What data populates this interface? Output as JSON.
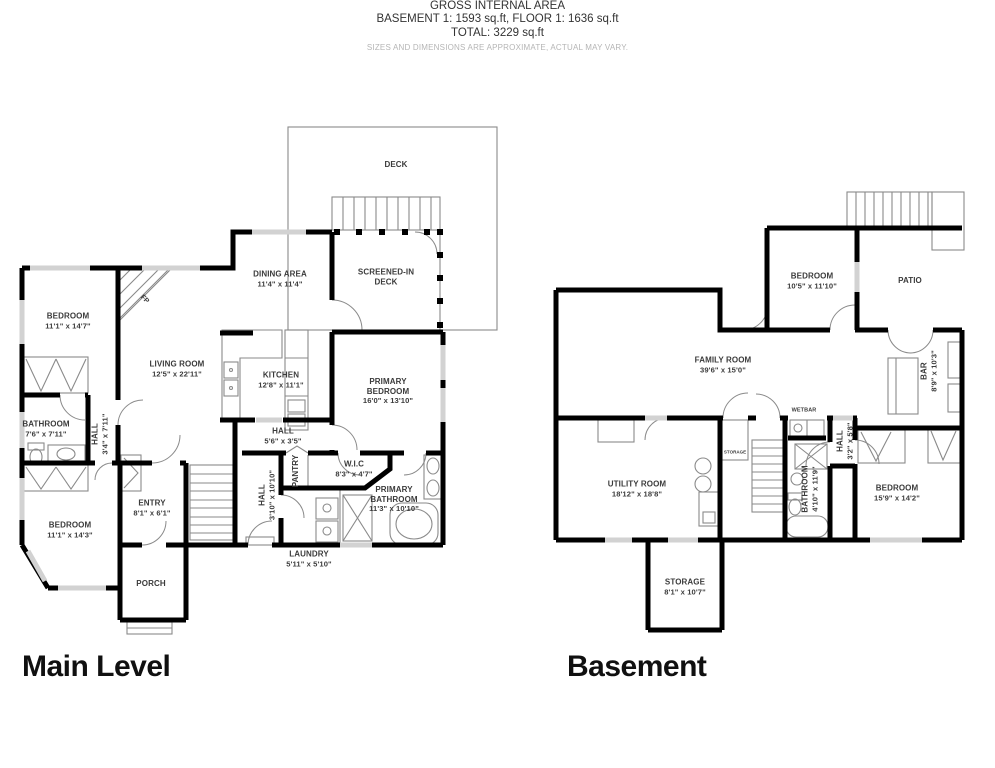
{
  "colors": {
    "wall": "#000000",
    "window": "#d2d2d2",
    "line": "#777777",
    "label_text": "#3b3b3b",
    "title_text": "#101010",
    "disclaimer_text": "#b5b5b5",
    "background": "#ffffff"
  },
  "main_plan": {
    "title": "Main Level",
    "rooms": [
      {
        "name": "DECK",
        "dims": ""
      },
      {
        "name": "SCREENED-IN DECK",
        "dims": ""
      },
      {
        "name": "DINING AREA",
        "dims": "11'4\" x 11'4\""
      },
      {
        "name": "BEDROOM",
        "dims": "11'1\" x 14'7\""
      },
      {
        "name": "LIVING ROOM",
        "dims": "12'5\" x 22'11\""
      },
      {
        "name": "KITCHEN",
        "dims": "12'8\" x 11'1\""
      },
      {
        "name": "PRIMARY BEDROOM",
        "dims": "16'0\" x 13'10\""
      },
      {
        "name": "BATHROOM",
        "dims": "7'6\" x 7'11\""
      },
      {
        "name": "HALL",
        "dims": "3'4\" x 7'11\""
      },
      {
        "name": "HALL",
        "dims": "5'6\" x 3'5\""
      },
      {
        "name": "PANTRY",
        "dims": ""
      },
      {
        "name": "W.I.C",
        "dims": "8'3\" x 4'7\""
      },
      {
        "name": "HALL",
        "dims": "3'10\" x 10'10\""
      },
      {
        "name": "PRIMARY BATHROOM",
        "dims": "11'3\" x 10'10\""
      },
      {
        "name": "ENTRY",
        "dims": "8'1\" x 6'1\""
      },
      {
        "name": "BEDROOM",
        "dims": "11'1\" x 14'3\""
      },
      {
        "name": "LAUNDRY",
        "dims": "5'11\" x 5'10\""
      },
      {
        "name": "PORCH",
        "dims": ""
      },
      {
        "name": "FP",
        "dims": ""
      }
    ]
  },
  "basement_plan": {
    "title": "Basement",
    "rooms": [
      {
        "name": "BEDROOM",
        "dims": "10'5\" x 11'10\""
      },
      {
        "name": "PATIO",
        "dims": ""
      },
      {
        "name": "FAMILY ROOM",
        "dims": "39'6\" x 15'0\""
      },
      {
        "name": "BAR",
        "dims": "8'9\" x 10'3\""
      },
      {
        "name": "WETBAR",
        "dims": ""
      },
      {
        "name": "STORAGE",
        "dims": ""
      },
      {
        "name": "UTILITY ROOM",
        "dims": "18'12\" x 18'8\""
      },
      {
        "name": "BATHROOM",
        "dims": "4'10\" x 11'9\""
      },
      {
        "name": "HALL",
        "dims": "3'2\" x 5'8\""
      },
      {
        "name": "BEDROOM",
        "dims": "15'9\" x 14'2\""
      },
      {
        "name": "STORAGE",
        "dims": "8'1\" x 10'7\""
      }
    ]
  },
  "footer": {
    "heading": "GROSS INTERNAL AREA",
    "areas": "BASEMENT 1: 1593 sq.ft, FLOOR 1: 1636 sq.ft",
    "total": "TOTAL: 3229 sq.ft",
    "disclaimer": "SIZES AND DIMENSIONS ARE APPROXIMATE, ACTUAL MAY VARY."
  }
}
